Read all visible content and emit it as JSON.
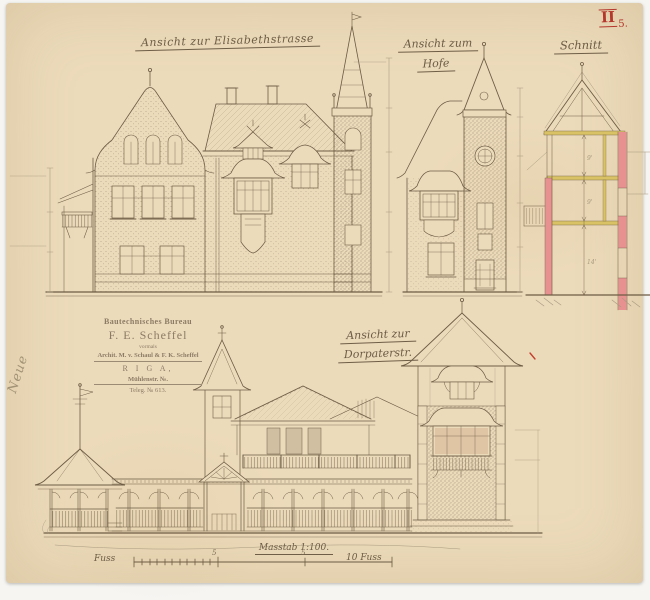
{
  "sheet": {
    "roman": "II",
    "number": "5."
  },
  "margin_note": "Neue",
  "titles": {
    "street": "Ansicht zur Elisabethstrasse",
    "hof_1": "Ansicht zum",
    "hof_2": "Hofe",
    "schnitt": "Schnitt",
    "dorpater_1": "Ansicht zur",
    "dorpater_2": "Dorpaterstr."
  },
  "stamp": {
    "office": "Bautechnisches Bureau",
    "name": "F. E. Scheffel",
    "formerly": "vormals",
    "predecessors": "Archit. M. v. Schaul & F. K. Scheffel",
    "city": "R I G A,",
    "address": "Mühlenstr. №.",
    "telegram": "Teleg. № 613."
  },
  "scale_bar": {
    "left_label": "Fuss",
    "title": "Masstab 1:100.",
    "tick_a": "5",
    "tick_b": "5",
    "right_label": "10 Fuss"
  },
  "section_dims": [
    "9'",
    "9'",
    "14'"
  ],
  "colors": {
    "paper": "#ecdbbb",
    "ink": "#6e5c44",
    "pencil": "#a8997f",
    "red_ink": "#b5372c",
    "section_wall_red": "#e89191",
    "floor_beam_yellow": "#d9c266"
  }
}
